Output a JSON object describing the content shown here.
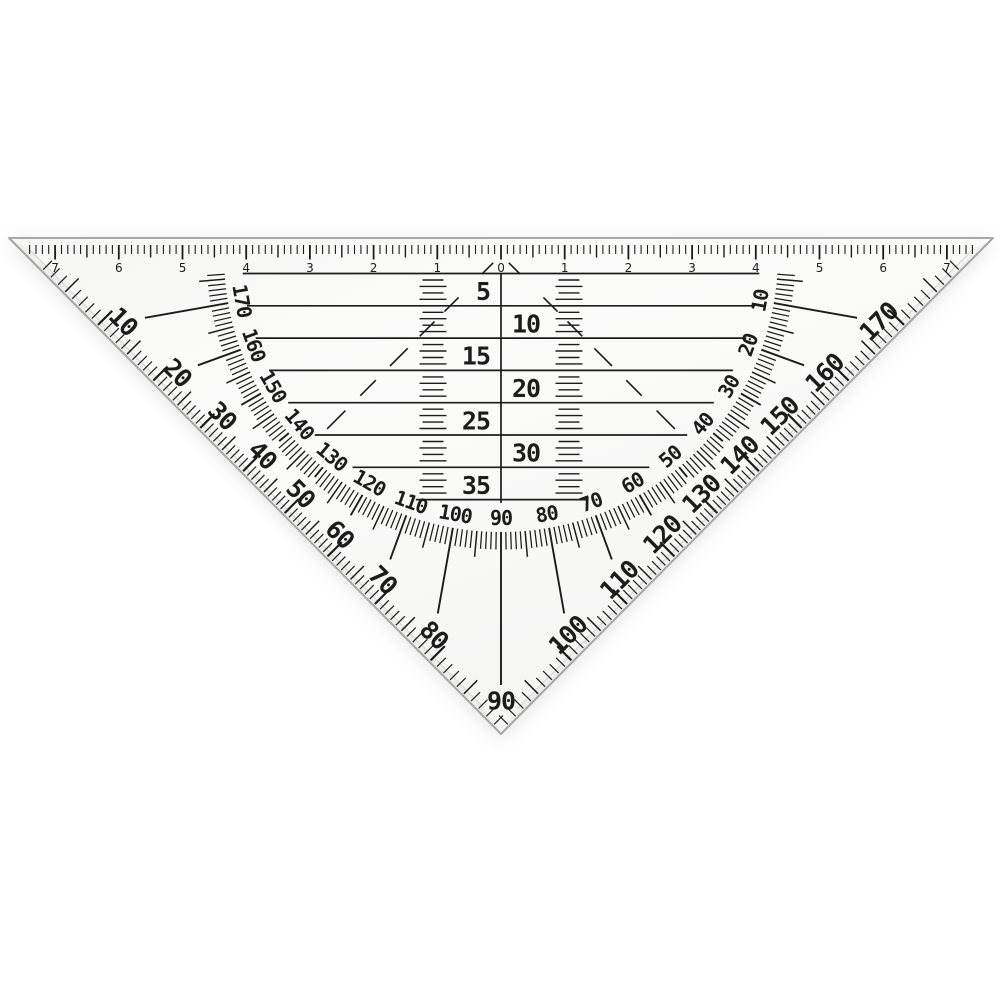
{
  "object": {
    "ink_color": "#1c1c1c",
    "face_color": "#fbfbfa",
    "edge_color": "#a9a9a9",
    "bevel_line_color": "#d8d8d8"
  },
  "ruler": {
    "unit_step_labels": [
      "7",
      "6",
      "5",
      "4",
      "3",
      "2",
      "1",
      "0",
      "1",
      "2",
      "3",
      "4",
      "5",
      "6",
      "7"
    ]
  },
  "parallel_rows": {
    "labels": [
      "5",
      "10",
      "15",
      "20",
      "25",
      "30",
      "35"
    ]
  },
  "protractor": {
    "inner_scale_labels": [
      "10",
      "20",
      "30",
      "40",
      "50",
      "60",
      "70",
      "80",
      "90",
      "100",
      "110",
      "120",
      "130",
      "140",
      "150",
      "160",
      "170"
    ],
    "outer_scale_labels": [
      "10",
      "20",
      "30",
      "40",
      "50",
      "60",
      "70",
      "80",
      "90",
      "100",
      "110",
      "120",
      "130",
      "140",
      "150",
      "160",
      "170"
    ],
    "minor_step_degrees": 1,
    "medium_step_degrees": 5,
    "labeled_step_degrees": 10
  }
}
